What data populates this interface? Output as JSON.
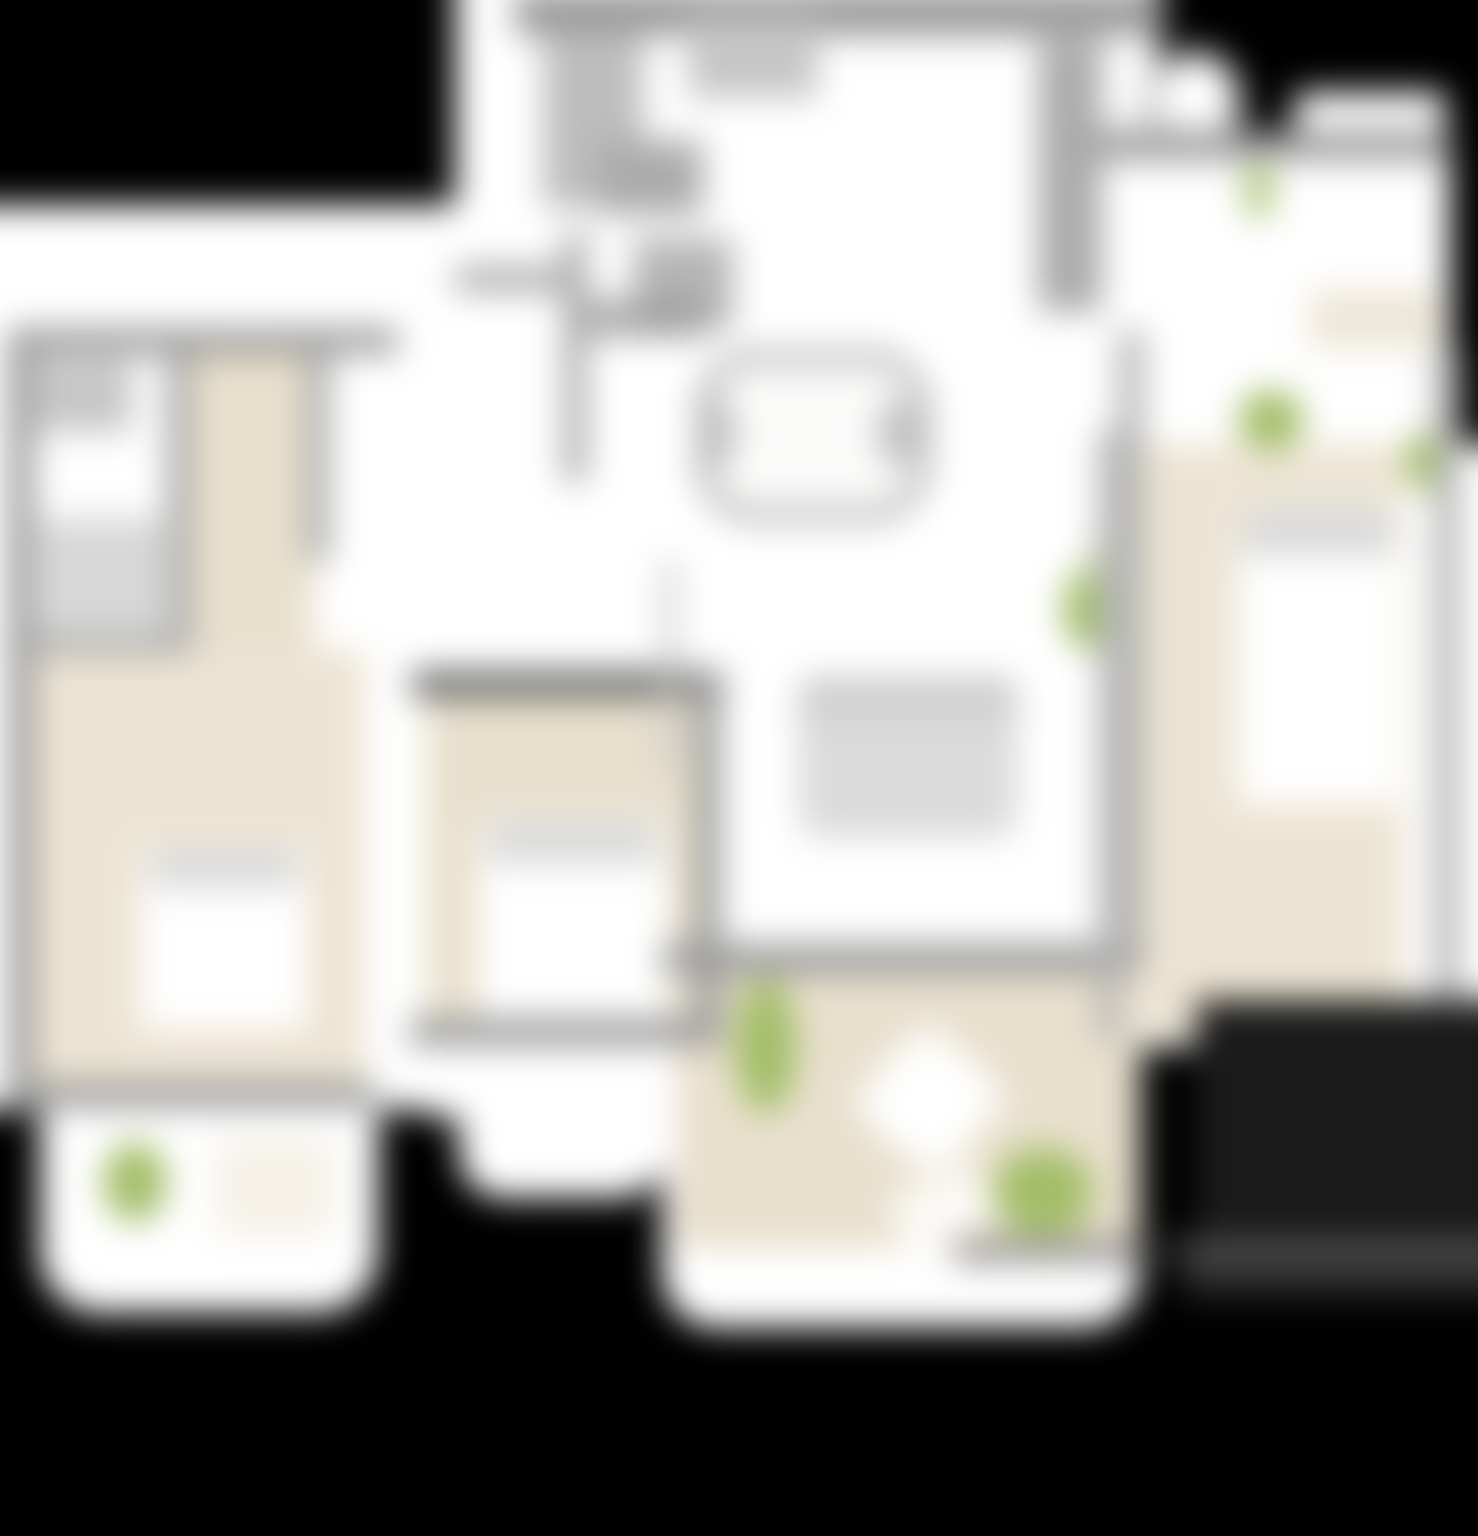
{
  "scene": {
    "description": "heavily blurred apartment floor plan on black background",
    "blur_px": 17,
    "background": "#000000"
  },
  "palette": {
    "background_black": "#000000",
    "page_white": "#ffffff",
    "near_white": "#fbfbfa",
    "floor_beige": "#e8e0cd",
    "floor_beige_soft": "#ece4d3",
    "plant_green": "#a3bd68",
    "plant_green_soft": "#c3d39c",
    "wall_gray": "#9a9a9a",
    "wall_gray_light": "#b5b5b5",
    "wall_gray_medium": "#ababab",
    "wall_dark": "#6a6a6a",
    "wall_charcoal": "#3f3f3f",
    "furniture_gray": "#d7d7d7",
    "furniture_gray_deep": "#c6c6c6",
    "counter_gray": "#bdbdbd",
    "pillow_gray": "#d9d9d9",
    "shadow_charcoal": "#1a1a1a",
    "band_gray": "#4a4a4a",
    "band_dim": "#262626"
  }
}
